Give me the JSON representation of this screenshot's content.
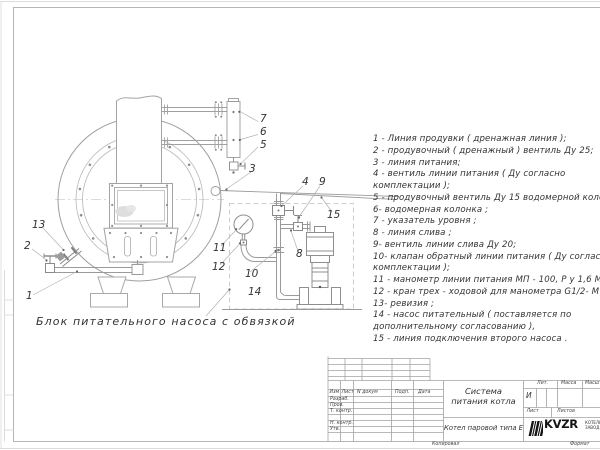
{
  "colors": {
    "line_gray": "#9e9e9e",
    "light_gray": "#bdbdbd",
    "text": "#3a3a3a",
    "logo_black": "#141414",
    "background": "#ffffff"
  },
  "drawing": {
    "caption": "Блок питательного насоса с обвязкой",
    "legend_lines": [
      "1 -  Линия продувки  ( дренажная  линия );",
      "2 -  продувочный  ( дренажный )  вентиль  Ду 25;",
      "3 -  линия питания;",
      "4 -  вентиль линии питания  ( Ду  согласно",
      "комплектации );",
      "5 -  продувочный вентиль  Ду 15  водомерной  колонки",
      "6-  водомерная  колонка ;",
      "7 -  указатель  уровня ;",
      "8 -  линия слива ;",
      "9-  вентиль линии  слива  Ду 20;",
      "10-  клапан  обратный линии  питания  ( Ду согласно",
      "комплектации );",
      "11 -  манометр линии питания  МП - 100,  Р у  1,6  МПа",
      "12 -  кран  трех - ходовой  для  манометра   G1/2- М 20",
      "13-  ревизия ;",
      "14 -  насос  питательный  ( поставляется  по",
      "дополнительному  согласованию ),",
      "15 -  линия  подключения  второго  насоса ."
    ],
    "callouts": [
      "1",
      "2",
      "3",
      "4",
      "5",
      "6",
      "7",
      "8",
      "9",
      "10",
      "11",
      "12",
      "13",
      "14",
      "15"
    ]
  },
  "title_block": {
    "doc_title_line1": "Система",
    "doc_title_line2": "питания котла",
    "subtitle": "Котел паровой типа Е",
    "litera_value": "И",
    "labels": {
      "izm": "Изм",
      "list_col": "Лист",
      "n_dokum": "N докум",
      "podp": "Подп.",
      "data": "Дата",
      "razrab": "Разраб.",
      "prov": "Пров.",
      "t_kontr": "Т. контр.",
      "n_kontr": "Н. контр.",
      "utv": "Утв.",
      "lit": "Лит.",
      "massa": "Масса",
      "masshtab": "Масшта",
      "list": "Лист",
      "listov": "Листов",
      "kopiroval": "Копировал",
      "format": "Формат"
    },
    "logo": {
      "text": "KVZR",
      "sub_line1": "КОТЕЛЬНЫЙ",
      "sub_line2": "ЗАВОД Р"
    }
  }
}
